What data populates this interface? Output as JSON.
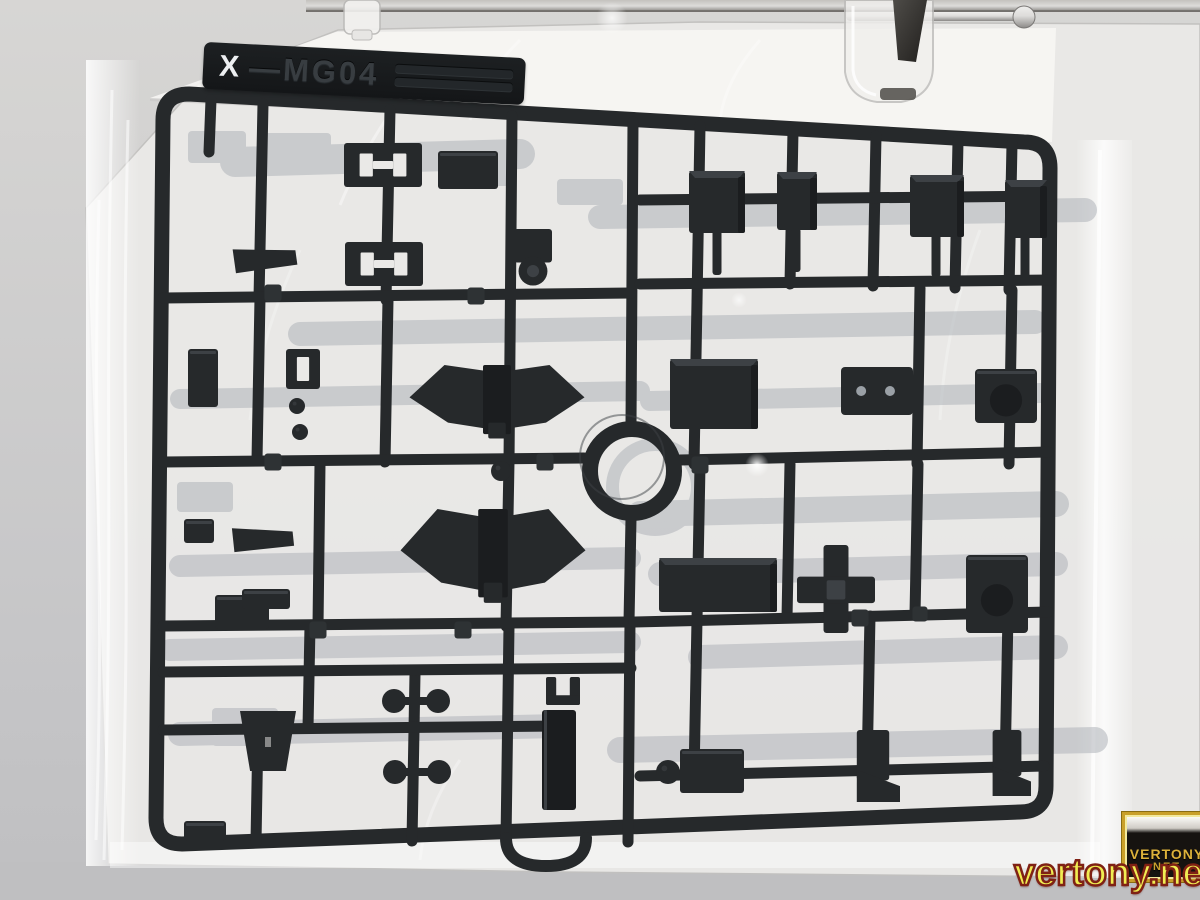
{
  "title": "Sealed bag with dark model-kit parts runner hanging from a clamp",
  "label": {
    "prefix": "X",
    "code": "—MG04"
  },
  "watermark": {
    "url": "vertony.net",
    "logo_line1": "VERTONY",
    "logo_line2": "NET"
  },
  "colors": {
    "bg_top": "#d7d6d4",
    "bg_bottom": "#c5c5c7",
    "bg_shadow": "#bfbfc1",
    "bag": "#eae9e7",
    "bag_bright": "#f7f6f4",
    "sprue": "#26292b",
    "sprue_edge": "#121416",
    "part_hi": "#3d4145",
    "part_lo": "#1b1d1f",
    "rear": "#b0b4ba",
    "metal_light": "#dddcda",
    "metal_dark": "#8b8987",
    "clamp_metal_hi": "#4e4c48",
    "clamp_metal_lo": "#211f1d",
    "accent_yellow": "#f0ed52",
    "accent_red": "#7f2114",
    "gold": "#c9a02a"
  },
  "scene": {
    "frame": {
      "tl": [
        163,
        94
      ],
      "tr": [
        1050,
        142
      ],
      "br": [
        1046,
        812
      ],
      "bl": [
        156,
        844
      ],
      "stroke": 15,
      "radius": 26
    },
    "ring": {
      "cx": 632,
      "cy": 471,
      "outer": 50,
      "inner": 34
    },
    "rear_ring": {
      "cx": 655,
      "cy": 487,
      "outer": 49,
      "inner": 36
    },
    "runners": [
      [
        263,
        104,
        259,
        298
      ],
      [
        390,
        110,
        386,
        300
      ],
      [
        512,
        116,
        509,
        462
      ],
      [
        633,
        122,
        631,
        424
      ],
      [
        700,
        126,
        697,
        302
      ],
      [
        793,
        131,
        790,
        284
      ],
      [
        876,
        136,
        873,
        286
      ],
      [
        958,
        141,
        955,
        288
      ],
      [
        1012,
        144,
        1009,
        290
      ],
      [
        211,
        100,
        209,
        152
      ],
      [
        631,
        519,
        629,
        622
      ],
      [
        260,
        298,
        257,
        460
      ],
      [
        388,
        300,
        385,
        462
      ],
      [
        320,
        464,
        318,
        626
      ],
      [
        509,
        462,
        506,
        626
      ],
      [
        697,
        302,
        694,
        464
      ],
      [
        790,
        464,
        787,
        618
      ],
      [
        920,
        288,
        917,
        464
      ],
      [
        1012,
        290,
        1009,
        464
      ],
      [
        918,
        464,
        915,
        614
      ],
      [
        700,
        466,
        697,
        620
      ],
      [
        697,
        620,
        694,
        776
      ],
      [
        870,
        616,
        867,
        772
      ],
      [
        1008,
        614,
        1005,
        770
      ],
      [
        509,
        626,
        506,
        840
      ],
      [
        415,
        674,
        412,
        841
      ],
      [
        310,
        626,
        308,
        728
      ],
      [
        258,
        728,
        256,
        842
      ],
      [
        630,
        622,
        628,
        842
      ],
      [
        163,
        298,
        631,
        293
      ],
      [
        640,
        200,
        1050,
        196
      ],
      [
        640,
        284,
        1050,
        280
      ],
      [
        163,
        462,
        584,
        458
      ],
      [
        680,
        460,
        1048,
        452
      ],
      [
        163,
        626,
        628,
        622
      ],
      [
        634,
        622,
        1048,
        612
      ],
      [
        163,
        672,
        631,
        668
      ],
      [
        640,
        776,
        1044,
        766
      ],
      [
        163,
        730,
        558,
        726
      ]
    ],
    "rear_bars": [
      [
        300,
        334,
        1035,
        322,
        24
      ],
      [
        180,
        399,
        640,
        391,
        20
      ],
      [
        650,
        401,
        1040,
        393,
        20
      ],
      [
        640,
        514,
        1056,
        504,
        26
      ],
      [
        180,
        566,
        630,
        558,
        22
      ],
      [
        660,
        574,
        1056,
        564,
        24
      ],
      [
        170,
        650,
        630,
        642,
        22
      ],
      [
        700,
        657,
        1056,
        647,
        24
      ],
      [
        180,
        734,
        560,
        726,
        24
      ],
      [
        620,
        750,
        1095,
        740,
        26
      ],
      [
        600,
        217,
        1085,
        210,
        24
      ],
      [
        235,
        162,
        520,
        154,
        30
      ]
    ],
    "rear_parts": [
      [
        217,
        147,
        58,
        32
      ],
      [
        297,
        150,
        68,
        34
      ],
      [
        482,
        170,
        66,
        32
      ],
      [
        590,
        192,
        66,
        26
      ],
      [
        245,
        727,
        66,
        38
      ],
      [
        205,
        497,
        56,
        30
      ]
    ],
    "parts": [
      [
        "bracketH",
        383,
        165,
        78,
        44,
        0
      ],
      [
        "bracketH",
        384,
        264,
        78,
        44,
        0
      ],
      [
        "box",
        468,
        170,
        60,
        38,
        0
      ],
      [
        "elbow",
        533,
        256,
        38,
        54,
        0
      ],
      [
        "clip",
        265,
        257,
        62,
        24,
        -8
      ],
      [
        "clip",
        263,
        537,
        60,
        24,
        -6
      ],
      [
        "box",
        242,
        612,
        54,
        34,
        0
      ],
      [
        "box",
        199,
        531,
        30,
        24,
        0
      ],
      [
        "box",
        205,
        831,
        42,
        20,
        0
      ],
      [
        "box",
        203,
        378,
        30,
        58,
        0
      ],
      [
        "slot",
        303,
        369,
        34,
        40,
        0
      ],
      [
        "ball",
        297,
        406,
        16,
        16,
        0
      ],
      [
        "ball",
        300,
        432,
        16,
        16,
        0
      ],
      [
        "ball",
        501,
        471,
        20,
        20,
        0
      ],
      [
        "wing",
        497,
        401,
        175,
        72,
        0
      ],
      [
        "wing",
        493,
        555,
        185,
        92,
        0
      ],
      [
        "block",
        717,
        202,
        56,
        62,
        0
      ],
      [
        "block",
        797,
        201,
        40,
        58,
        0
      ],
      [
        "block",
        937,
        206,
        54,
        62,
        0
      ],
      [
        "block",
        1026,
        209,
        42,
        58,
        0
      ],
      [
        "stem",
        717,
        252,
        9,
        46,
        0
      ],
      [
        "stem",
        796,
        250,
        9,
        44,
        0
      ],
      [
        "stem",
        936,
        254,
        9,
        46,
        0
      ],
      [
        "stem",
        1025,
        256,
        9,
        44,
        0
      ],
      [
        "block",
        714,
        394,
        88,
        70,
        0
      ],
      [
        "plate",
        877,
        391,
        72,
        48,
        0
      ],
      [
        "joint",
        1006,
        396,
        62,
        54,
        0
      ],
      [
        "block",
        718,
        585,
        118,
        54,
        0
      ],
      [
        "cross",
        836,
        589,
        78,
        88,
        0
      ],
      [
        "joint",
        997,
        594,
        62,
        78,
        0
      ],
      [
        "boot",
        873,
        766,
        54,
        72,
        0
      ],
      [
        "boot",
        1007,
        763,
        48,
        66,
        0
      ],
      [
        "box",
        712,
        771,
        64,
        44,
        0
      ],
      [
        "ball",
        668,
        772,
        24,
        24,
        0
      ],
      [
        "trap",
        268,
        741,
        56,
        60,
        0
      ],
      [
        "dumbbell",
        416,
        701,
        64,
        16,
        0
      ],
      [
        "dumbbell",
        417,
        772,
        64,
        16,
        0
      ],
      [
        "fork",
        563,
        691,
        34,
        28,
        0
      ],
      [
        "slab",
        559,
        760,
        34,
        100,
        0
      ],
      [
        "hook",
        546,
        852,
        80,
        28,
        0
      ],
      [
        "box",
        266,
        599,
        48,
        20,
        0
      ],
      [
        "tag",
        273,
        293,
        17,
        17,
        0
      ],
      [
        "tag",
        476,
        296,
        17,
        17,
        0
      ],
      [
        "tag",
        273,
        462,
        17,
        17,
        0
      ],
      [
        "tag",
        545,
        462,
        17,
        17,
        0
      ],
      [
        "tag",
        700,
        465,
        17,
        17,
        0
      ],
      [
        "tag",
        463,
        630,
        17,
        17,
        0
      ],
      [
        "tag",
        318,
        630,
        17,
        17,
        0
      ],
      [
        "tag",
        860,
        618,
        17,
        17,
        0
      ],
      [
        "tag",
        920,
        614,
        15,
        15,
        0
      ]
    ]
  }
}
